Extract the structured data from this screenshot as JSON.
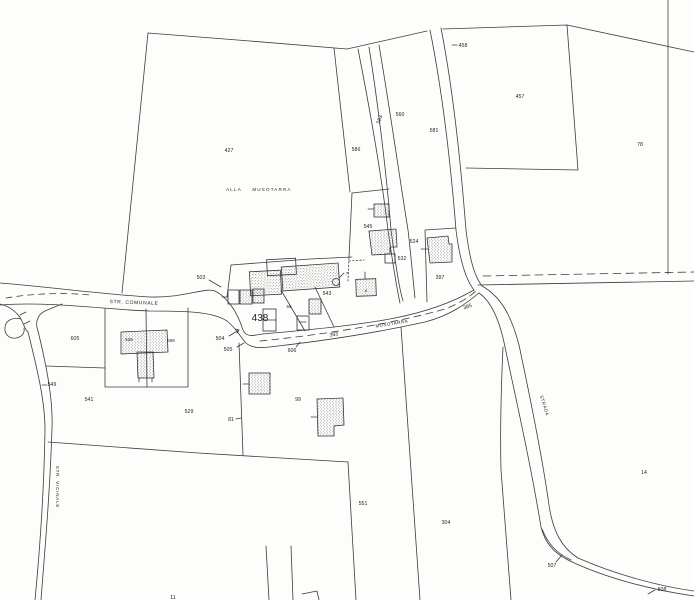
{
  "map": {
    "type": "cadastral-parcel-map",
    "bg_color": "#fdfdfc",
    "line_color": "#3b3b3b",
    "text_color": "#1f1f1f",
    "parcel_labels": [
      {
        "id": "427",
        "text": "427",
        "x": 229,
        "y": 152
      },
      {
        "id": "458",
        "text": "458",
        "x": 463,
        "y": 47
      },
      {
        "id": "457",
        "text": "457",
        "x": 520,
        "y": 98
      },
      {
        "id": "78",
        "text": "78",
        "x": 640,
        "y": 146
      },
      {
        "id": "586",
        "text": "586",
        "x": 356,
        "y": 151
      },
      {
        "id": "583",
        "text": "583",
        "x": 381,
        "y": 120,
        "rot": -70
      },
      {
        "id": "560",
        "text": "560",
        "x": 400,
        "y": 116
      },
      {
        "id": "581",
        "text": "581",
        "x": 434,
        "y": 132
      },
      {
        "id": "545",
        "text": "545",
        "x": 368,
        "y": 228
      },
      {
        "id": "524",
        "text": "524",
        "x": 414,
        "y": 243
      },
      {
        "id": "532",
        "text": "532",
        "x": 402,
        "y": 260
      },
      {
        "id": "397",
        "text": "397",
        "x": 440,
        "y": 279
      },
      {
        "id": "503",
        "text": "503",
        "x": 201,
        "y": 279
      },
      {
        "id": "438",
        "text": "438",
        "x": 260,
        "y": 321,
        "size": 10
      },
      {
        "id": "543",
        "text": "543",
        "x": 327,
        "y": 295
      },
      {
        "id": "69",
        "text": "69",
        "x": 289,
        "y": 308,
        "size": 4.5
      },
      {
        "id": "7",
        "text": "7",
        "x": 347,
        "y": 275,
        "size": 4.5
      },
      {
        "id": "8",
        "text": "8",
        "x": 366,
        "y": 292,
        "size": 4
      },
      {
        "id": "504",
        "text": "504",
        "x": 220,
        "y": 340
      },
      {
        "id": "505",
        "text": "505",
        "x": 228,
        "y": 351
      },
      {
        "id": "606",
        "text": "606",
        "x": 292,
        "y": 352
      },
      {
        "id": "393",
        "text": "393",
        "x": 334,
        "y": 336,
        "rot": -8
      },
      {
        "id": "385",
        "text": "385",
        "x": 468,
        "y": 308,
        "rot": -18
      },
      {
        "id": "605",
        "text": "605",
        "x": 75,
        "y": 340
      },
      {
        "id": "528",
        "text": "528",
        "x": 129,
        "y": 341,
        "size": 4.5
      },
      {
        "id": "608",
        "text": "608",
        "x": 171,
        "y": 342,
        "size": 4.5
      },
      {
        "id": "549",
        "text": "549",
        "x": 52,
        "y": 386
      },
      {
        "id": "541",
        "text": "541",
        "x": 89,
        "y": 401
      },
      {
        "id": "529",
        "text": "529",
        "x": 189,
        "y": 413
      },
      {
        "id": "81",
        "text": "81",
        "x": 231,
        "y": 421
      },
      {
        "id": "99",
        "text": "99",
        "x": 298,
        "y": 401
      },
      {
        "id": "551",
        "text": "551",
        "x": 363,
        "y": 505
      },
      {
        "id": "304",
        "text": "304",
        "x": 446,
        "y": 524
      },
      {
        "id": "14",
        "text": "14",
        "x": 644,
        "y": 474
      },
      {
        "id": "507",
        "text": "507",
        "x": 552,
        "y": 567
      },
      {
        "id": "508",
        "text": "508",
        "x": 662,
        "y": 591
      },
      {
        "id": "11",
        "text": "11",
        "x": 173,
        "y": 599
      }
    ],
    "road_labels": [
      {
        "id": "str-comunale",
        "text": "STR.  COMUNALE",
        "x": 134,
        "y": 304,
        "rot": 2,
        "size": 5,
        "spacing": 0.6
      },
      {
        "id": "alla",
        "text": "ALLA",
        "x": 234,
        "y": 191,
        "size": 4.5,
        "spacing": 1.2
      },
      {
        "id": "musotarra-place",
        "text": "MUSOTARRA",
        "x": 272,
        "y": 191,
        "size": 4.5,
        "spacing": 1.2
      },
      {
        "id": "musotarra-road",
        "text": "MUSOTARRA",
        "x": 392,
        "y": 325,
        "rot": -9,
        "size": 4.5,
        "spacing": 0.5
      },
      {
        "id": "strada",
        "text": "STRADA",
        "x": 543,
        "y": 406,
        "rot": 73,
        "size": 4.5,
        "spacing": 0.5
      },
      {
        "id": "str-vicinale",
        "text": "STR.  VICINALE",
        "x": 56,
        "y": 487,
        "rot": 90,
        "size": 4.5,
        "spacing": 0.8
      }
    ]
  }
}
